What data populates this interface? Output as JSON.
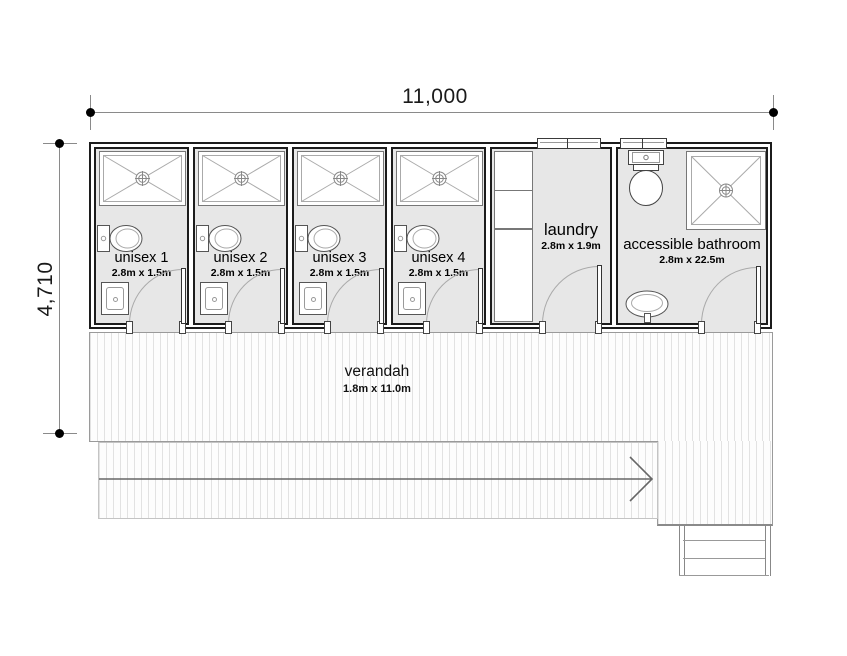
{
  "title": "amenities floor plan",
  "dimension_annotations": {
    "top_width": "11,000",
    "left_height": "4,710"
  },
  "rooms": [
    {
      "name": "unisex 1",
      "dims": "2.8m x 1.5m"
    },
    {
      "name": "unisex 2",
      "dims": "2.8m x 1.5m"
    },
    {
      "name": "unisex 3",
      "dims": "2.8m x 1.5m"
    },
    {
      "name": "unisex 4",
      "dims": "2.8m x 1.5m"
    },
    {
      "name": "laundry",
      "dims": "2.8m x 1.9m"
    },
    {
      "name": "accessible bathroom",
      "dims": "2.8m x 22.5m"
    }
  ],
  "outdoor": {
    "verandah": {
      "name": "verandah",
      "dims": "1.8m x 11.0m"
    }
  },
  "colors": {
    "wall": "#1c1c1c",
    "room_floor": "#e7e7e7",
    "fixture_stroke": "#555555",
    "dimension_line": "#8a8a8a",
    "hatch_line": "#e2e2e2"
  }
}
